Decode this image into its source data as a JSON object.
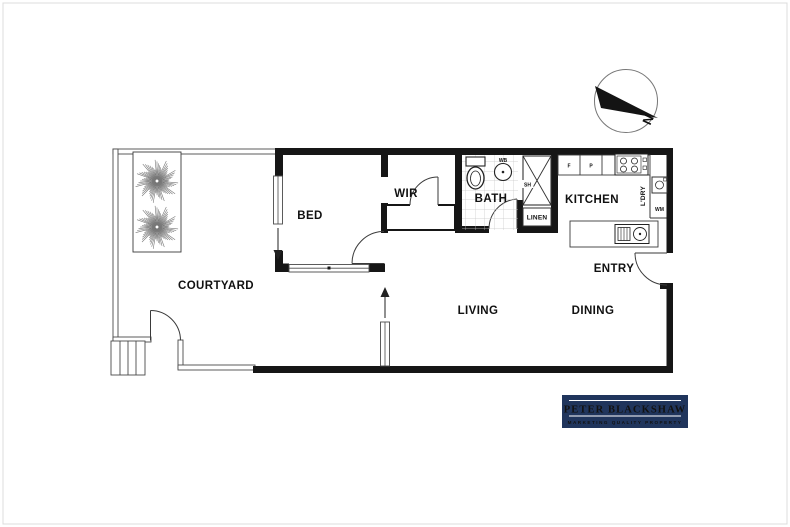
{
  "rooms": {
    "courtyard": "COURTYARD",
    "bed": "BED",
    "wir": "WIR",
    "bath": "BATH",
    "kitchen": "KITCHEN",
    "living": "LIVING",
    "dining": "DINING",
    "entry": "ENTRY"
  },
  "fixtures": {
    "linen": "LINEN",
    "laundry": "L'DRY",
    "washing_machine": "WM",
    "fridge": "F",
    "pantry": "P",
    "shower": "SH",
    "basin": "WB"
  },
  "compass": {
    "north": "N"
  },
  "logo": {
    "title": "PETER BLACKSHAW",
    "tagline": "MARKETING QUALITY PROPERTY",
    "colors": {
      "bg": "#20355c",
      "title": "#ffffff",
      "tagline": "#c8ab72"
    }
  },
  "colors": {
    "wall": "#161616",
    "thin_wall": "#555555",
    "tile": "#c6c6c6",
    "tree": "#777777"
  }
}
